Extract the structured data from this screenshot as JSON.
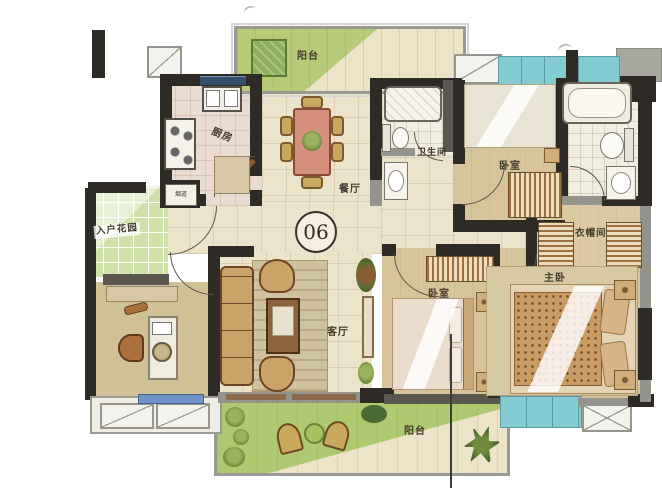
{
  "unit": {
    "number": "06"
  },
  "labels": {
    "balcony_top": "阳台",
    "kitchen": "厨房",
    "flue": "烟道",
    "dining": "餐厅",
    "entry_garden": "入户花园",
    "bathroom": "卫生间",
    "bedroom_top": "卧室",
    "bedroom_mid": "卧室",
    "cloakroom": "衣帽间",
    "master_bedroom": "主卧",
    "living": "客厅",
    "balcony_bottom": "阳台"
  },
  "colors": {
    "wall": "#2e2a25",
    "window": "#84ccd2",
    "balcony_green": "#b6ca78",
    "floor_cream": "#ece3cb",
    "bedroom_tan": "#d7c49a"
  }
}
